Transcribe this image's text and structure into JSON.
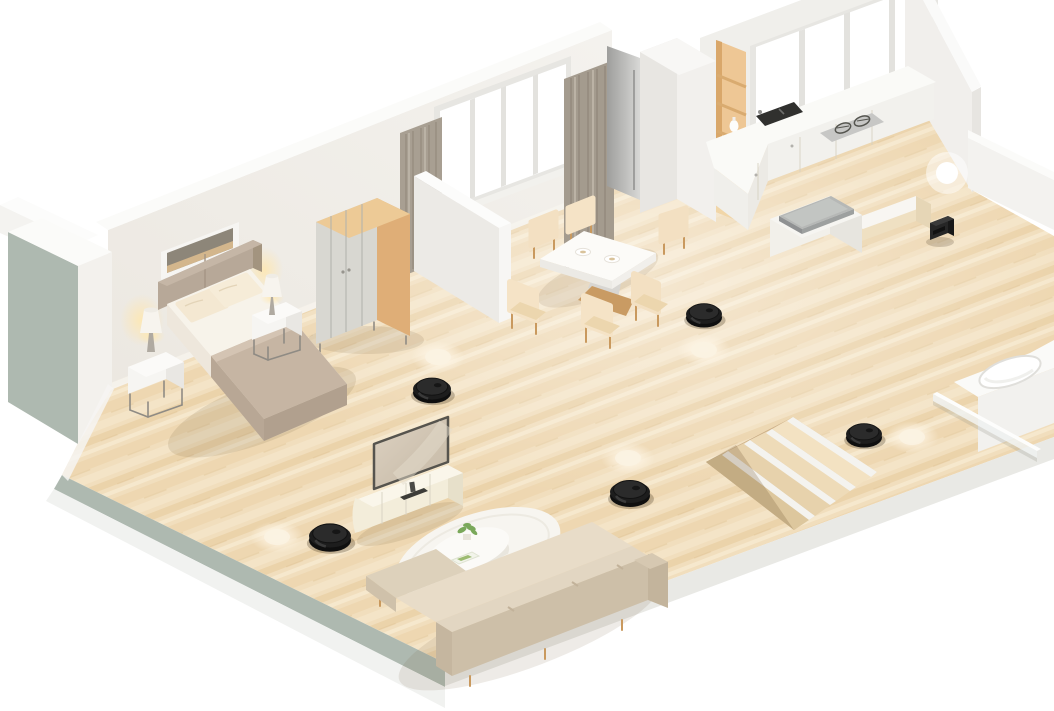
{
  "scene": {
    "description": "Isometric 3D cutaway floor plan of an apartment with robot vacuum cleaners and glowing location markers",
    "view": "isometric-cutaway",
    "background_color": "#ffffff",
    "colors": {
      "floor_wood": "#f0ddbb",
      "floor_wood_dark": "#ead2a9",
      "wall_interior": "#f0eee9",
      "wall_top": "#fbfbf9",
      "exterior_slab": "#aeb9b0",
      "wood_accent": "#e0af78",
      "curtain": "#a89f92",
      "upholstery_cream": "#f3e0c2",
      "sofa_beige": "#d5c7b1",
      "bed_blanket": "#c6b5a3",
      "robot_body": "#1d1d1d",
      "robot_top": "#2b2b2b",
      "robot_shadow": "rgba(60,45,25,0.28)",
      "marker_core": "#ffffff",
      "marker_floor_core": "#fbf2e2",
      "dock_body": "#262626",
      "steel": "#c7c7c5",
      "sink": "#30302e"
    },
    "rooms": [
      {
        "name": "bedroom",
        "furniture": [
          "double-bed",
          "headboard",
          "pillows",
          "nightstand-left",
          "table-lamp-left",
          "nightstand-right",
          "table-lamp-right",
          "wardrobe",
          "wall-shelf-niche",
          "window-with-curtains"
        ]
      },
      {
        "name": "dining-area",
        "furniture": [
          "dining-table",
          "six-dining-chairs",
          "two-place-settings",
          "window-with-curtains"
        ]
      },
      {
        "name": "kitchen",
        "furniture": [
          "l-shaped-counter",
          "double-sink",
          "gas-cooktop",
          "kitchen-island-with-steel-top",
          "bench",
          "built-in-wooden-shelf",
          "vases",
          "fridge",
          "window-band"
        ]
      },
      {
        "name": "living-room",
        "furniture": [
          "tv",
          "tv-console",
          "round-rug",
          "round-coffee-table",
          "potted-plant",
          "book",
          "side-table",
          "l-shaped-sectional-sofa"
        ]
      },
      {
        "name": "stairwell",
        "furniture": [
          "sunken-staircase"
        ]
      },
      {
        "name": "bathroom",
        "furniture": [
          "bathtub",
          "glass-screen"
        ]
      }
    ],
    "furniture_positions": [
      {
        "name": "double-bed",
        "x": 255,
        "y": 345
      },
      {
        "name": "wardrobe",
        "x": 363,
        "y": 268
      },
      {
        "name": "nightstand-left",
        "x": 156,
        "y": 372
      },
      {
        "name": "nightstand-right",
        "x": 277,
        "y": 320
      },
      {
        "name": "wall-shelf-niche",
        "x": 200,
        "y": 250
      },
      {
        "name": "dining-table",
        "x": 598,
        "y": 255
      },
      {
        "name": "kitchen-island",
        "x": 816,
        "y": 224
      },
      {
        "name": "sink",
        "x": 777,
        "y": 115
      },
      {
        "name": "cooktop",
        "x": 853,
        "y": 127
      },
      {
        "name": "built-in-shelf",
        "x": 730,
        "y": 128
      },
      {
        "name": "tv-console",
        "x": 408,
        "y": 498
      },
      {
        "name": "tv",
        "x": 411,
        "y": 453
      },
      {
        "name": "coffee-table",
        "x": 468,
        "y": 550
      },
      {
        "name": "round-rug",
        "x": 478,
        "y": 554
      },
      {
        "name": "sofa",
        "x": 520,
        "y": 610
      },
      {
        "name": "staircase",
        "x": 791,
        "y": 473
      },
      {
        "name": "bathtub",
        "x": 1016,
        "y": 395
      }
    ],
    "devices": {
      "robot_vacuums": [
        {
          "id": 1,
          "room": "hallway-near-bedroom",
          "x": 432,
          "y": 389,
          "scale": 0.95
        },
        {
          "id": 2,
          "room": "dining-area",
          "x": 704,
          "y": 314,
          "scale": 0.9
        },
        {
          "id": 3,
          "room": "living-room-center",
          "x": 630,
          "y": 492,
          "scale": 1.0
        },
        {
          "id": 4,
          "room": "stairwell",
          "x": 864,
          "y": 434,
          "scale": 0.9
        },
        {
          "id": 5,
          "room": "living-room-left",
          "x": 330,
          "y": 536,
          "scale": 1.05
        }
      ],
      "charging_dock": {
        "x": 940,
        "y": 228
      },
      "location_markers": [
        {
          "x": 438,
          "y": 357,
          "surface": "floor"
        },
        {
          "x": 704,
          "y": 350,
          "surface": "floor"
        },
        {
          "x": 628,
          "y": 458,
          "surface": "floor"
        },
        {
          "x": 912,
          "y": 437,
          "surface": "floor"
        },
        {
          "x": 277,
          "y": 537,
          "surface": "floor"
        },
        {
          "x": 947,
          "y": 173,
          "surface": "wall"
        }
      ]
    }
  }
}
